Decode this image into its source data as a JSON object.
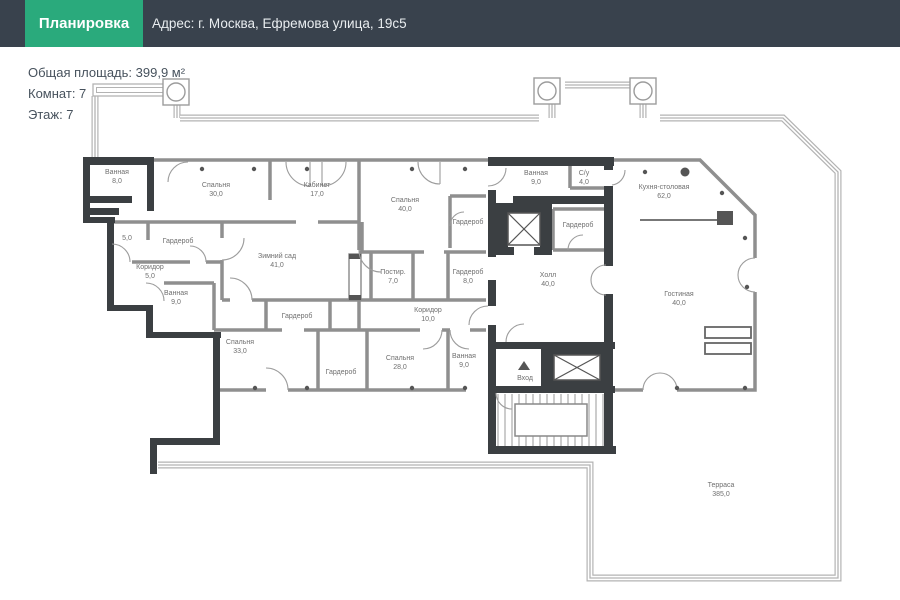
{
  "header": {
    "title": "Планировка",
    "address": "Адрес: г. Москва,  Ефремова улица, 19с5"
  },
  "info": {
    "total_area": "Общая площадь: 399,9 м²",
    "rooms_count": "Комнат: 7",
    "floor": "Этаж: 7"
  },
  "colors": {
    "header_bg": "#39424d",
    "accent_green": "#2aaa7c",
    "wall_dark": "#3b3f42",
    "wall_gray": "#8f8f8f",
    "terrace_outline": "#b3b3b3",
    "label_gray": "#6f6f6f"
  },
  "icons": {
    "entrance_marker": "triangle-up-icon",
    "elevator": "crossed-box-icon",
    "column": "circle-in-square-icon"
  },
  "rooms": [
    {
      "name": "Ванная",
      "area": "8,0"
    },
    {
      "name": "Спальня",
      "area": "30,0"
    },
    {
      "name": "Кабинет",
      "area": "17,0"
    },
    {
      "name": "Спальня",
      "area": "40,0"
    },
    {
      "name": "Ванная",
      "area": "9,0"
    },
    {
      "name": "С/у",
      "area": "4,0"
    },
    {
      "name": "Кухня-столовая",
      "area": "62,0"
    },
    {
      "name": "Гардероб",
      "area": ""
    },
    {
      "name": "Гардероб",
      "area": ""
    },
    {
      "name": "",
      "area": "5,0"
    },
    {
      "name": "Гардероб",
      "area": ""
    },
    {
      "name": "Зимний сад",
      "area": "41,0"
    },
    {
      "name": "Коридор",
      "area": "5,0"
    },
    {
      "name": "Постир.",
      "area": "7,0"
    },
    {
      "name": "Гардероб",
      "area": "8,0"
    },
    {
      "name": "Холл",
      "area": "40,0"
    },
    {
      "name": "Ванная",
      "area": "9,0"
    },
    {
      "name": "Гостиная",
      "area": "40,0"
    },
    {
      "name": "Гардероб",
      "area": ""
    },
    {
      "name": "Коридор",
      "area": "10,0"
    },
    {
      "name": "Спальня",
      "area": "33,0"
    },
    {
      "name": "Гардероб",
      "area": ""
    },
    {
      "name": "Спальня",
      "area": "28,0"
    },
    {
      "name": "Ванная",
      "area": "9,0"
    },
    {
      "name": "Вход",
      "area": ""
    },
    {
      "name": "Терраса",
      "area": "385,0"
    }
  ]
}
